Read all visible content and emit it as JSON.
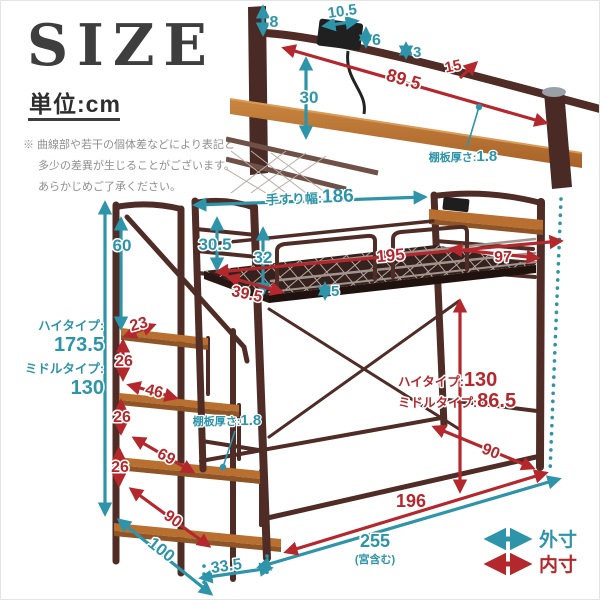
{
  "header": {
    "title": "SIZE",
    "unit_label": "単位:cm",
    "note_lines": [
      "※ 曲線部や若干の個体差などにより表記と",
      "多少の差異が生じることがございます。",
      "あらかじめご了承ください。"
    ]
  },
  "colors": {
    "outer_dimension": "#2e94a9",
    "inner_dimension": "#b4282d",
    "frame": "#4f2c26",
    "wood": "#b86f30"
  },
  "top_diagram": {
    "rail_above_shelf": "8",
    "outlet_width": "10.5",
    "outlet_height": "6",
    "gap": "3",
    "shelf_depth": "15",
    "shelf_length": "89.5",
    "headboard_height": "30",
    "board_label": "棚板厚さ:",
    "board_thickness": "1.8"
  },
  "main_diagram": {
    "handrail_label": "手すり幅:",
    "handrail_width": "186",
    "footboard_rail": "30.5",
    "guardrail_height": "32",
    "inner_length": "195",
    "inner_width_foot": "39.5",
    "deck_lip": "5",
    "inner_width_head": "97",
    "stair_rail_height": "60",
    "left_high_label": "ハイタイプ:",
    "left_high_value": "173.5",
    "left_mid_label": "ミドルタイプ:",
    "left_mid_value": "130",
    "step1_depth": "23",
    "rise1": "26",
    "step2_depth": "46",
    "rise2": "26",
    "step3_depth": "69",
    "rise3": "26",
    "step4_depth": "90",
    "stair_depth": "100",
    "stair_gap": "33.5",
    "board_label": "棚板厚さ:",
    "board_thickness": "1.8",
    "right_high_label": "ハイタイプ:",
    "right_high_value": "130",
    "right_mid_label": "ミドルタイプ:",
    "right_mid_value": "86.5",
    "under_bed_depth": "90",
    "floor_inner_length": "196",
    "floor_outer_length": "255",
    "floor_outer_note": "(宮含む)"
  },
  "legend": {
    "outer_label": "外寸",
    "inner_label": "内寸"
  }
}
